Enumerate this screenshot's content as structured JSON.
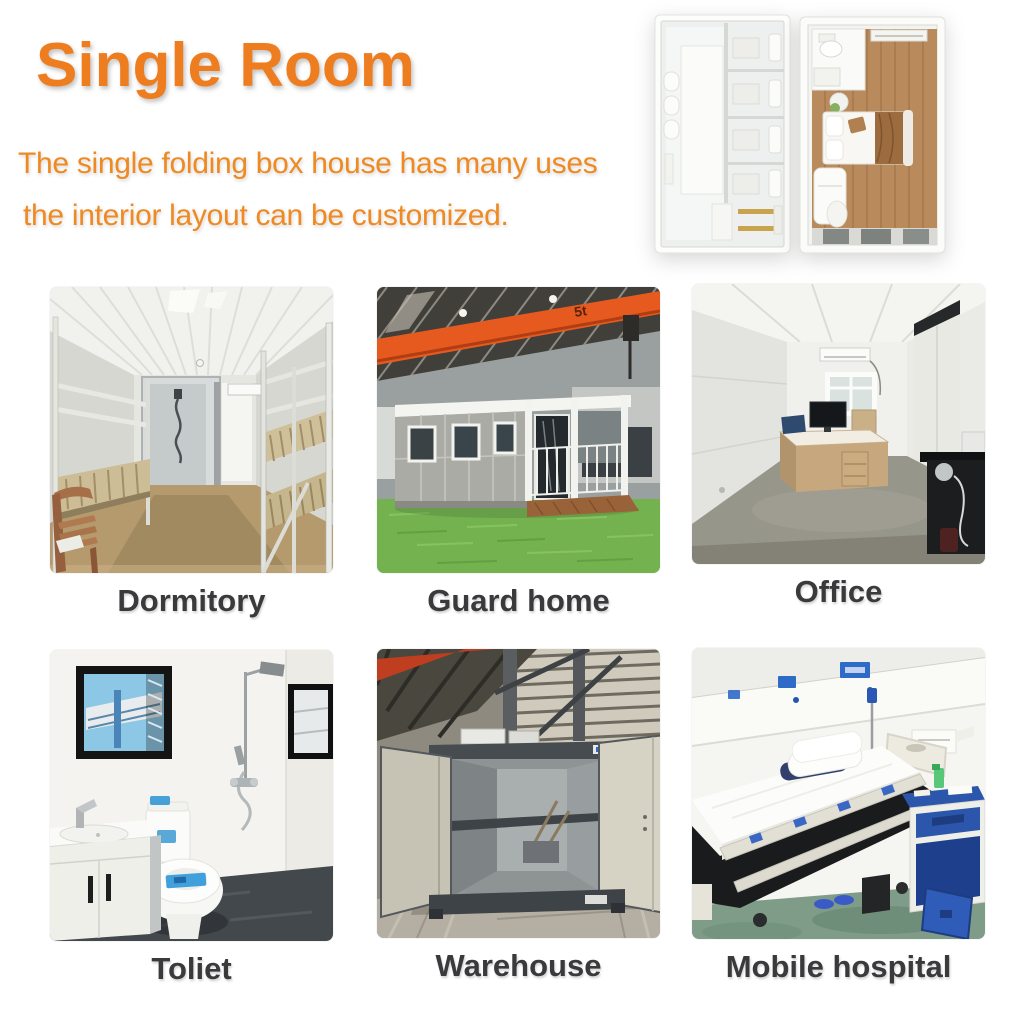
{
  "header": {
    "title": "Single Room",
    "subtitle_line1": "The single folding box house has many uses",
    "subtitle_line2": "the interior layout can be customized."
  },
  "floorplans": {
    "left_name": "bathroom-unit-floor-plan",
    "right_name": "bedroom-unit-floor-plan"
  },
  "gallery": {
    "items": [
      {
        "label": "Dormitory",
        "photo": "dormitory-photo"
      },
      {
        "label": "Guard home",
        "photo": "guard-home-photo",
        "crane_label": "5t"
      },
      {
        "label": "Office",
        "photo": "office-photo"
      },
      {
        "label": "Toliet",
        "photo": "toliet-photo"
      },
      {
        "label": "Warehouse",
        "photo": "warehouse-photo"
      },
      {
        "label": "Mobile hospital",
        "photo": "mobile-hospital-photo"
      }
    ]
  },
  "colors": {
    "accent_title": "#ED7D1F",
    "accent_subtitle": "#EF8A22",
    "caption": "#3A3A3C"
  }
}
